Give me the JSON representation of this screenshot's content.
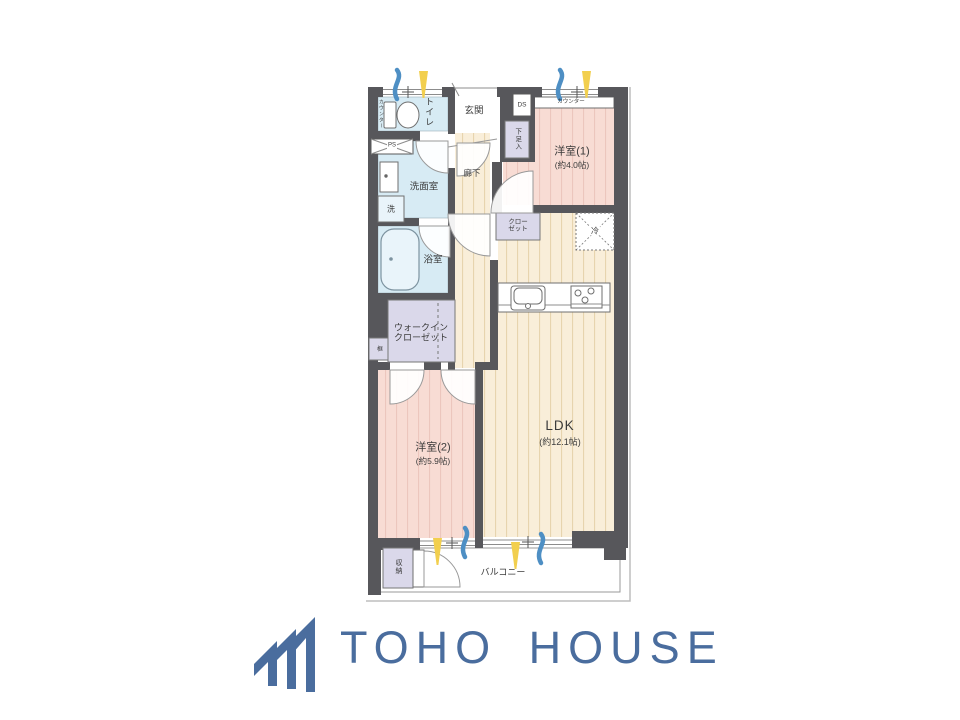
{
  "floorplan": {
    "labels": {
      "western1_name": "洋室(1)",
      "western1_size": "(約4.0帖)",
      "western2_name": "洋室(2)",
      "western2_size": "(約5.9帖)",
      "ldk_name": "LDK",
      "ldk_size": "(約12.1帖)",
      "entrance": "玄関",
      "toilet": "トイレ",
      "counter_toilet": "カウンター",
      "counter_bedroom": "カウンター",
      "ds": "DS",
      "ps": "PS",
      "shoe_cabinet": "下足入",
      "washroom": "洗面室",
      "washer": "洗",
      "hallway": "廊下",
      "closet_line1": "クロー",
      "closet_line2": "ゼット",
      "refrigerator": "冷",
      "bathroom": "浴室",
      "wic_line1": "ウォークイン",
      "wic_line2": "クローゼット",
      "kamachi": "框",
      "storage": "収納",
      "balcony": "バルコニー"
    }
  },
  "logo": {
    "brand": "TOHO HOUSE"
  },
  "colors": {
    "wall": "#57575b",
    "pink": "#f8dcd4",
    "pinkline": "#ecc6bd",
    "beige": "#f9eed9",
    "beigeline": "#e7d4ae",
    "water": "#d7ebf4",
    "purple": "#dad8ea",
    "sun": "#f2cf4e",
    "breeze": "#4e8fc4",
    "logo": "#4a6d9e",
    "label": "#3b3b3b"
  }
}
